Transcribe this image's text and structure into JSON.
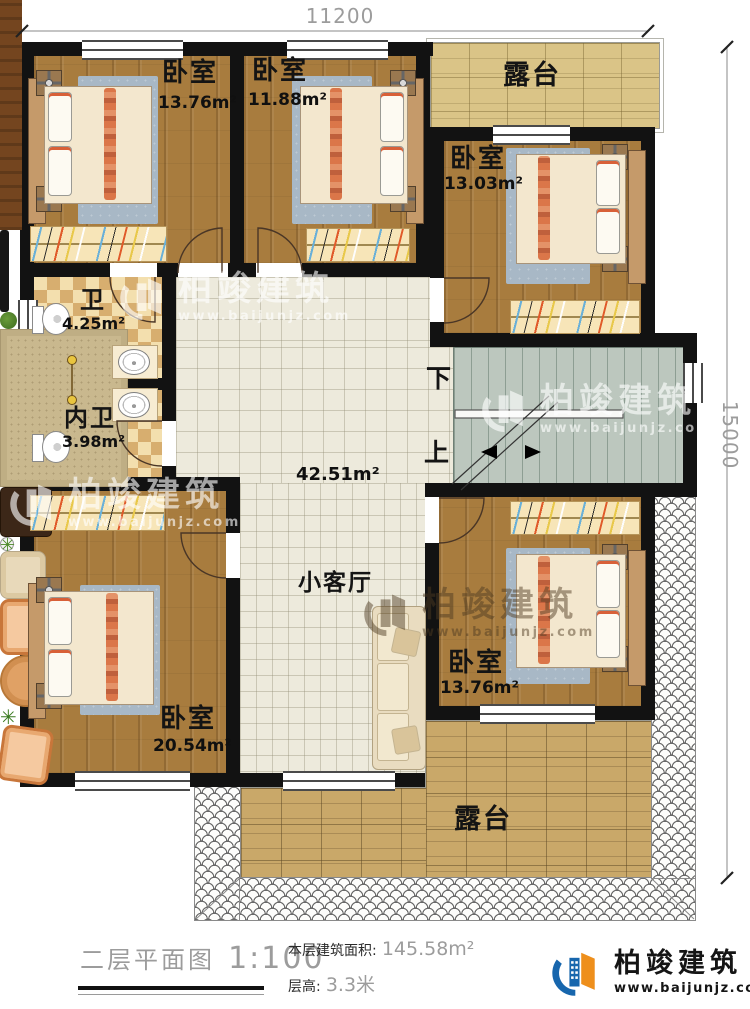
{
  "dimensions": {
    "width_mm": "11200",
    "height_mm": "15000"
  },
  "rooms": {
    "bedroom_tl": {
      "label": "卧室",
      "area": "13.76m²"
    },
    "bedroom_tm": {
      "label": "卧室",
      "area": "11.88m²"
    },
    "bedroom_tr": {
      "label": "卧室",
      "area": "13.03m²"
    },
    "bath": {
      "label": "卫",
      "area": "4.25m²"
    },
    "inner_bath": {
      "label": "内卫",
      "area": "3.98m²"
    },
    "hall": {
      "area": "42.51m²"
    },
    "living": {
      "label": "小客厅"
    },
    "bedroom_bl": {
      "label": "卧室",
      "area": "20.54m²"
    },
    "bedroom_br": {
      "label": "卧室",
      "area": "13.76m²"
    },
    "terrace_top": {
      "label": "露台"
    },
    "terrace_bottom": {
      "label": "露台"
    }
  },
  "stairs": {
    "down": "下",
    "up": "上"
  },
  "watermark": {
    "brand": "柏竣建筑",
    "url": "www.baijunjz.com"
  },
  "footer": {
    "plan_title": "二层平面图",
    "plan_scale": "1:100",
    "area_label": "本层建筑面积:",
    "area_value": "145.58m²",
    "floor_height_label": "层高:",
    "floor_height_value": "3.3米",
    "brand": "柏竣建筑",
    "brand_url": "www.baijunjz.com"
  },
  "colors": {
    "wall": "#121212",
    "wood_floor": "#a87c3e",
    "tile_floor": "#edeadc",
    "bath_checker": "#d7ae6f",
    "terrace_top_floor": "#dac487",
    "terrace_bottom_floor": "#c9a869",
    "stairs_floor": "#bcc7be",
    "brand_blue": "#1766ad",
    "brand_orange": "#ee8f1c"
  }
}
